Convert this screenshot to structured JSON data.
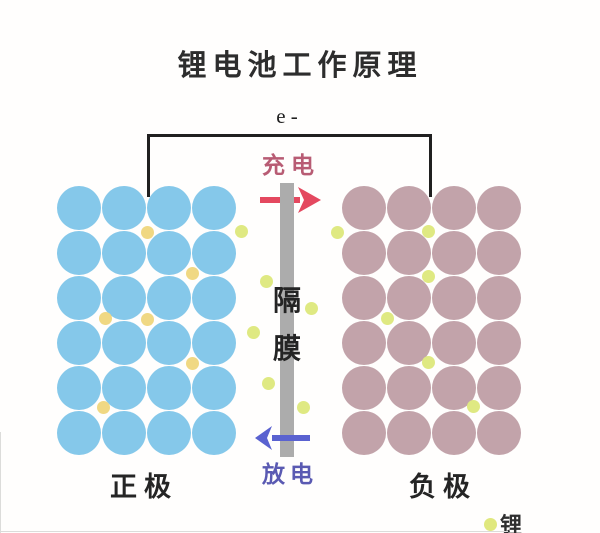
{
  "title": "锂电池工作原理",
  "circuit": {
    "electron_label": "e -",
    "wire_color": "#202020"
  },
  "charge": {
    "label": "充电",
    "label_color": "#b85c74",
    "arrow_color": "#e4485f",
    "direction": "right"
  },
  "discharge": {
    "label": "放电",
    "label_color": "#5a5ab2",
    "arrow_color": "#5a62d0",
    "direction": "left"
  },
  "separator": {
    "label": "隔膜",
    "chars": [
      "隔",
      "膜"
    ],
    "bar_color": "#acacac"
  },
  "electrodes": {
    "positive": {
      "label": "正极",
      "rows": 6,
      "cols": 4,
      "particle_color": "#85c8ea"
    },
    "negative": {
      "label": "负极",
      "rows": 6,
      "cols": 4,
      "particle_color": "#c2a3aa"
    }
  },
  "lithium": {
    "legend_label": "锂",
    "legend_dot_color": "#e0e87e",
    "cathode_ion_color": "#f0d883",
    "channel_ion_color": "#dfe982",
    "cathode_ion_positions": [
      [
        147,
        232
      ],
      [
        192,
        273
      ],
      [
        105,
        318
      ],
      [
        147,
        319
      ],
      [
        192,
        363
      ],
      [
        103,
        407
      ]
    ],
    "channel_ion_positions": [
      [
        241,
        231
      ],
      [
        266,
        281
      ],
      [
        253,
        332
      ],
      [
        268,
        383
      ],
      [
        311,
        308
      ],
      [
        303,
        407
      ],
      [
        337,
        232
      ],
      [
        428,
        231
      ],
      [
        428,
        276
      ],
      [
        387,
        318
      ],
      [
        428,
        362
      ],
      [
        473,
        406
      ]
    ]
  }
}
